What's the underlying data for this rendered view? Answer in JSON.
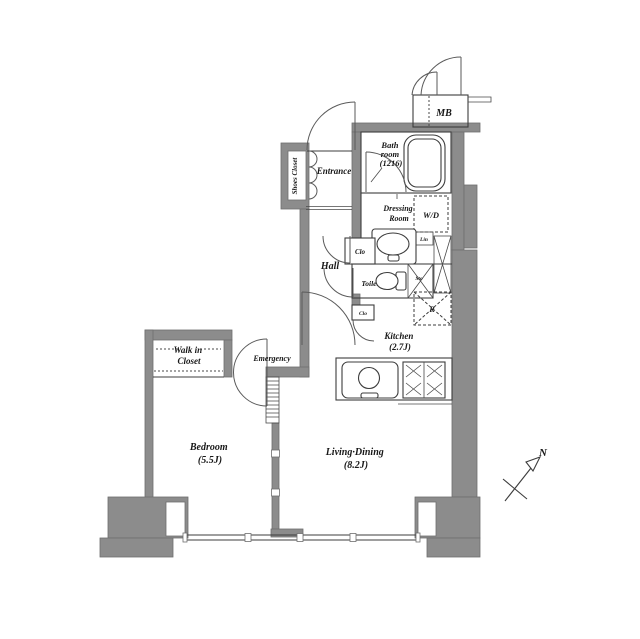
{
  "plan_labels": {
    "mb": "MB",
    "bathroom": {
      "lines": [
        "Bath",
        "room",
        "(1216)"
      ]
    },
    "entrance": "Entrance",
    "shoes_closet": "Shoes Closet",
    "hall": "Hall",
    "dressing_room": {
      "lines": [
        "Dressing",
        "Room"
      ]
    },
    "washer_dryer": "W/D",
    "linen": "Lin",
    "closet_hall": "Clo",
    "toilet": "Toilet",
    "storage": "Sto",
    "kitchen": {
      "lines": [
        "Kitchen",
        "(2.7J)"
      ]
    },
    "refrigerator": "R",
    "closet_kitchen": "Clo",
    "walk_in_closet": {
      "lines": [
        "Walk in",
        "Closet"
      ]
    },
    "emergency": "Emergency",
    "bedroom": {
      "lines": [
        "Bedroom",
        "(5.5J)"
      ]
    },
    "living_dining": {
      "lines": [
        "Living·Dining",
        "(8.2J)"
      ]
    },
    "compass_north": "N"
  },
  "colors": {
    "wall": "#8c8c8c",
    "line": "#3c3c3c",
    "background": "#ffffff"
  }
}
